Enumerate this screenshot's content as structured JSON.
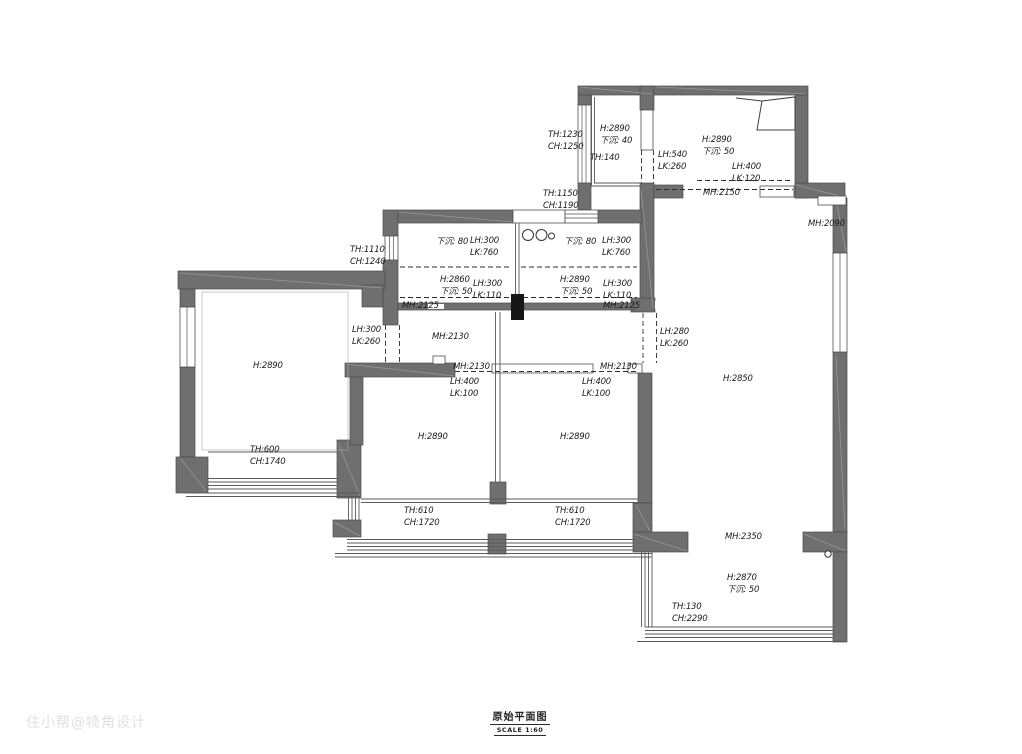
{
  "title_block": {
    "title": "原始平面图",
    "scale": "SCALE 1:60"
  },
  "watermark": "住小帮@犄角设计",
  "colors": {
    "wall": "#6f6f6f",
    "wall_edge": "#4b4b4b",
    "text": "#1b1b1b",
    "dashed_line": "#2d2d2d"
  },
  "legend_terms": [
    "H=层高",
    "TH=窗台高",
    "CH=窗高",
    "LH=梁高",
    "LK=梁宽",
    "MH=门洞高",
    "下沉=下沉深度"
  ],
  "annotations": [
    {
      "x": 548,
      "y": 130,
      "lines": [
        "TH:1230",
        "CH:1250"
      ]
    },
    {
      "x": 600,
      "y": 124,
      "lines": [
        "H:2890",
        "下沉: 40"
      ]
    },
    {
      "x": 590,
      "y": 153,
      "lines": [
        "TH:140"
      ]
    },
    {
      "x": 658,
      "y": 150,
      "lines": [
        "LH:540",
        "LK:260"
      ]
    },
    {
      "x": 702,
      "y": 135,
      "lines": [
        "H:2890",
        "下沉: 50"
      ]
    },
    {
      "x": 732,
      "y": 162,
      "lines": [
        "LH:400",
        "LK:120"
      ]
    },
    {
      "x": 703,
      "y": 188,
      "lines": [
        "MH:2150"
      ]
    },
    {
      "x": 543,
      "y": 189,
      "lines": [
        "TH:1150",
        "CH:1190"
      ]
    },
    {
      "x": 808,
      "y": 219,
      "lines": [
        "MH:2090"
      ]
    },
    {
      "x": 350,
      "y": 245,
      "lines": [
        "TH:1110",
        "CH:1240"
      ]
    },
    {
      "x": 436,
      "y": 237,
      "lines": [
        "下沉: 80"
      ]
    },
    {
      "x": 470,
      "y": 236,
      "lines": [
        "LH:300",
        "LK:760"
      ]
    },
    {
      "x": 564,
      "y": 237,
      "lines": [
        "下沉: 80"
      ]
    },
    {
      "x": 602,
      "y": 236,
      "lines": [
        "LH:300",
        "LK:760"
      ]
    },
    {
      "x": 440,
      "y": 275,
      "lines": [
        "H:2860",
        "下沉: 50"
      ]
    },
    {
      "x": 473,
      "y": 279,
      "lines": [
        "LH:300",
        "LK:110"
      ]
    },
    {
      "x": 560,
      "y": 275,
      "lines": [
        "H:2890",
        "下沉: 50"
      ]
    },
    {
      "x": 603,
      "y": 279,
      "lines": [
        "LH:300",
        "LK:110"
      ]
    },
    {
      "x": 402,
      "y": 301,
      "lines": [
        "MH:2125"
      ]
    },
    {
      "x": 603,
      "y": 301,
      "lines": [
        "MH:2125"
      ]
    },
    {
      "x": 352,
      "y": 325,
      "lines": [
        "LH:300",
        "LK:260"
      ]
    },
    {
      "x": 432,
      "y": 332,
      "lines": [
        "MH:2130"
      ]
    },
    {
      "x": 660,
      "y": 327,
      "lines": [
        "LH:280",
        "LK:260"
      ]
    },
    {
      "x": 453,
      "y": 362,
      "lines": [
        "MH:2130"
      ]
    },
    {
      "x": 600,
      "y": 362,
      "lines": [
        "MH:2130"
      ]
    },
    {
      "x": 450,
      "y": 377,
      "lines": [
        "LH:400",
        "LK:100"
      ]
    },
    {
      "x": 582,
      "y": 377,
      "lines": [
        "LH:400",
        "LK:100"
      ]
    },
    {
      "x": 253,
      "y": 361,
      "lines": [
        "H:2890"
      ]
    },
    {
      "x": 723,
      "y": 374,
      "lines": [
        "H:2850"
      ]
    },
    {
      "x": 418,
      "y": 432,
      "lines": [
        "H:2890"
      ]
    },
    {
      "x": 560,
      "y": 432,
      "lines": [
        "H:2890"
      ]
    },
    {
      "x": 250,
      "y": 445,
      "lines": [
        "TH:600",
        "CH:1740"
      ]
    },
    {
      "x": 404,
      "y": 506,
      "lines": [
        "TH:610",
        "CH:1720"
      ]
    },
    {
      "x": 555,
      "y": 506,
      "lines": [
        "TH:610",
        "CH:1720"
      ]
    },
    {
      "x": 725,
      "y": 532,
      "lines": [
        "MH:2350"
      ]
    },
    {
      "x": 727,
      "y": 573,
      "lines": [
        "H:2870",
        "下沉: 50"
      ]
    },
    {
      "x": 672,
      "y": 602,
      "lines": [
        "TH:130",
        "CH:2290"
      ]
    }
  ]
}
